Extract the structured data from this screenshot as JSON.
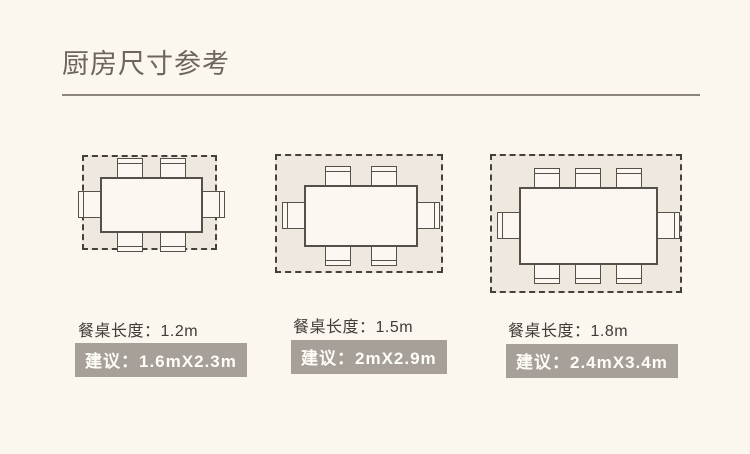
{
  "header": {
    "title": "厨房尺寸参考"
  },
  "colors": {
    "background": "#fbf6ee",
    "title_text": "#6e655c",
    "divider": "#8d857c",
    "clearance_fill": "#efe8df",
    "dash_stroke": "#45403a",
    "furniture_fill": "#fcf8f1",
    "furniture_stroke": "#56504a",
    "label_text": "#403c37",
    "badge_background": "#a6a099",
    "badge_text": "#fffdf7"
  },
  "diagrams": [
    {
      "id": "dining-table-1.2m",
      "seats": 6,
      "table_length_label": "餐桌长度：1.2m",
      "suggestion_label": "建议：1.6mX2.3m",
      "chairs": {
        "top": 2,
        "bottom": 2,
        "left": 1,
        "right": 1
      },
      "plan": {
        "x": 82,
        "y": 155,
        "w": 135,
        "h": 95,
        "table_w": 103,
        "table_h": 56
      },
      "label_pos": {
        "x": 78,
        "y": 317
      },
      "badge_pos": {
        "x": 75,
        "y": 343
      }
    },
    {
      "id": "dining-table-1.5m",
      "seats": 6,
      "table_length_label": "餐桌长度：1.5m",
      "suggestion_label": "建议：2mX2.9m",
      "chairs": {
        "top": 2,
        "bottom": 2,
        "left": 1,
        "right": 1
      },
      "plan": {
        "x": 275,
        "y": 154,
        "w": 168,
        "h": 119,
        "table_w": 114,
        "table_h": 62
      },
      "label_pos": {
        "x": 293,
        "y": 313
      },
      "badge_pos": {
        "x": 291,
        "y": 340
      }
    },
    {
      "id": "dining-table-1.8m",
      "seats": 8,
      "table_length_label": "餐桌长度：1.8m",
      "suggestion_label": "建议：2.4mX3.4m",
      "chairs": {
        "top": 3,
        "bottom": 3,
        "left": 1,
        "right": 1
      },
      "plan": {
        "x": 490,
        "y": 154,
        "w": 192,
        "h": 139,
        "table_w": 139,
        "table_h": 78
      },
      "label_pos": {
        "x": 508,
        "y": 317
      },
      "badge_pos": {
        "x": 506,
        "y": 344
      }
    }
  ]
}
